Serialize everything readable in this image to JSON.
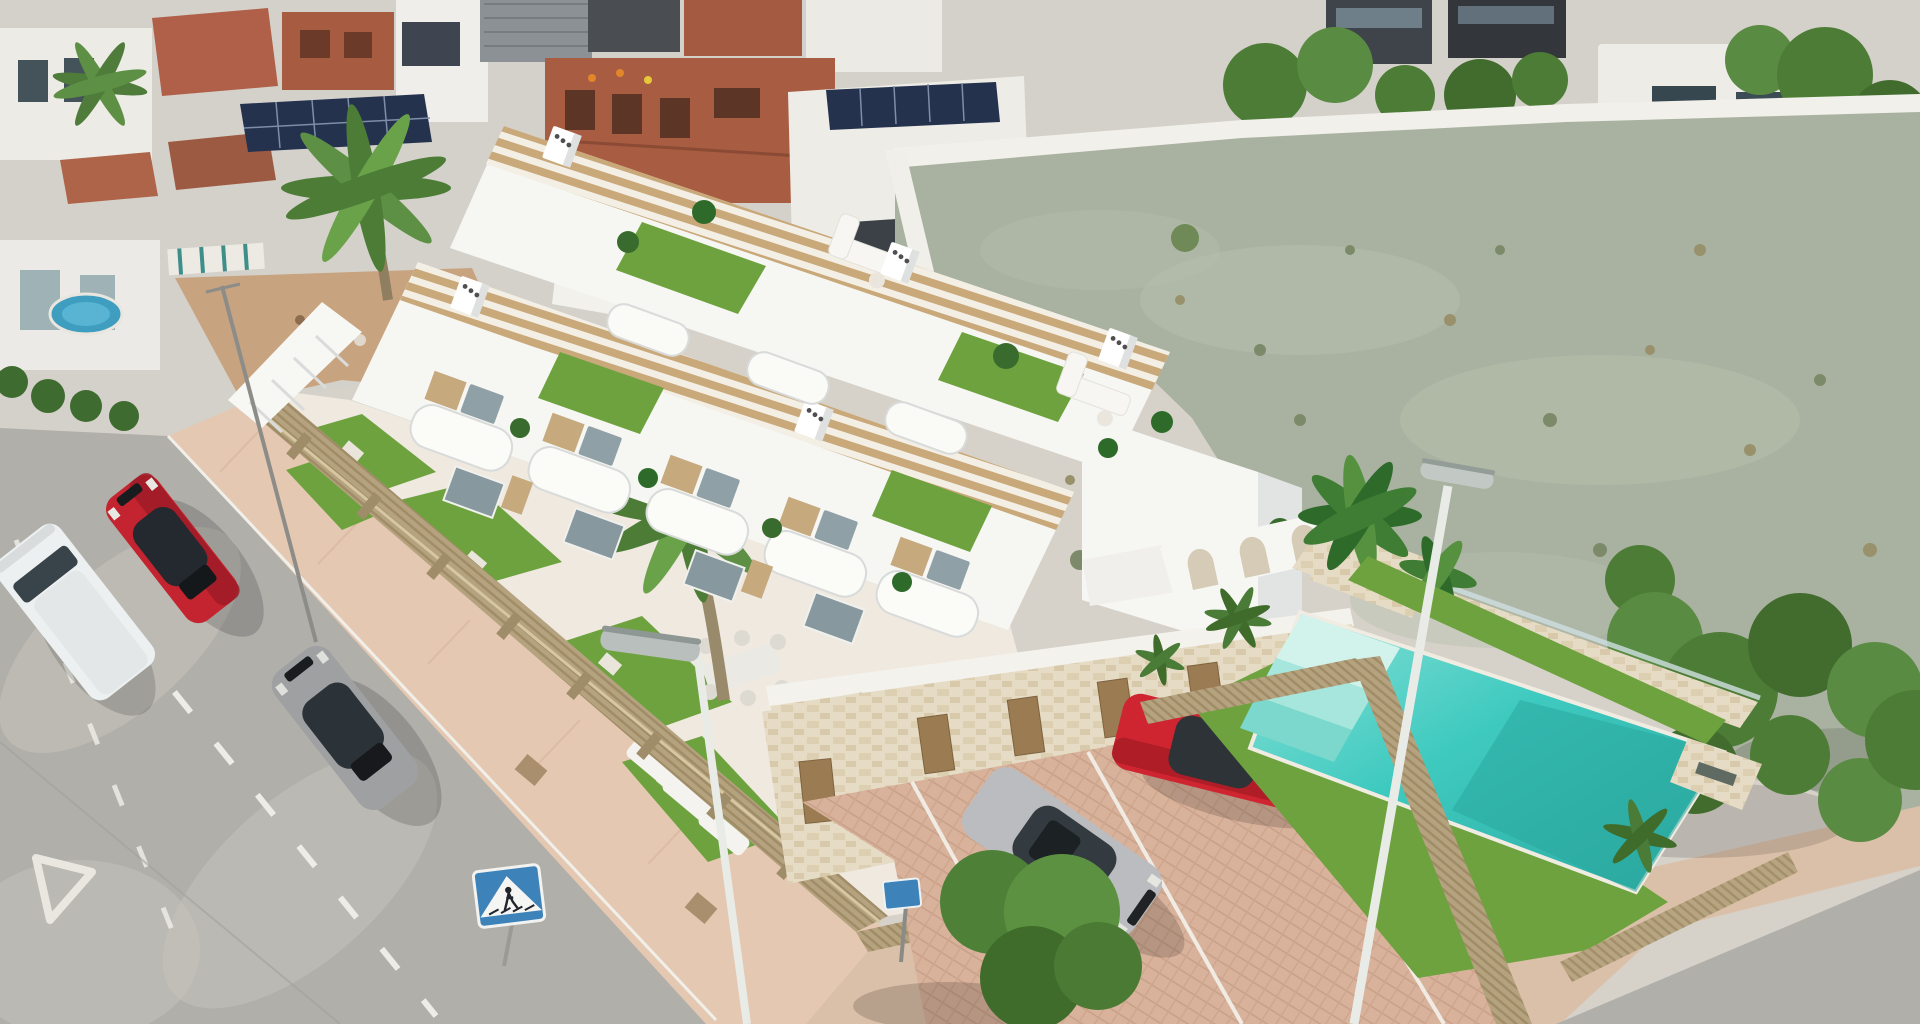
{
  "meta": {
    "title": "Aerial render of a new-build white townhouse complex with rooftop solariums, communal pool, parking court and adjacent vacant lot",
    "description": "Oblique drone view: modern white Mediterranean townhouses with wooden pergola solariums and artificial-grass terraces, tan slatted fences, travertine storage block, brick-paved parking with two cars, turquoise pool behind an arched white wall, surrounded by an existing village, streets with parked cars and a large sage-green vacant lot."
  },
  "palette": {
    "base": "#d6d2c9",
    "town_base": "#d4d1ca",
    "house_white": "#eeece7",
    "roof_terracotta": "#b06048",
    "roof_brick": "#a75c42",
    "roof_dark": "#4a4e53",
    "roof_metal": "#8b9194",
    "solar_panel": "#25324e",
    "field": "#a9b2a0",
    "field_patch": "#b7bfae",
    "weed_green": "#7d8a6a",
    "weed_dry": "#98916c",
    "wall_white": "#f1f0ea",
    "road": "#b1afaa",
    "road_worn": "#c6c3bc",
    "marking_white": "#eeece6",
    "sidewalk": "#e5c8b1",
    "sidewalk_dark": "#dbc0a9",
    "fence_tan": "#b5a27f",
    "fence_post": "#9f8c68",
    "building_white": "#f6f6f3",
    "building_shade": "#e2e4e4",
    "pergola_wood": "#c9a87a",
    "glass": "#8fa1a7",
    "wood_slat": "#c6a97d",
    "grass": "#6da23f",
    "stone": "#e6dcc5",
    "stone_cap": "#f4f2ec",
    "door_brown": "#9a7b52",
    "parking": "#d9b29c",
    "pool_water": "#3fcac0",
    "pool_deep": "#2aa89f",
    "pool_step": "#a6e6dc",
    "plant_dark": "#2e6b2b",
    "plant_mid": "#3f7d35",
    "palm_green": "#4f8f3f",
    "tree_green": "#4e8038",
    "tree_dark": "#3f6b2b",
    "car_red": "#c3242f",
    "car_red2": "#ce2531",
    "car_silver": "#bbbcbf",
    "car_gray": "#9fa0a2",
    "van_white": "#edf0f0",
    "window_dark": "#2f373e",
    "sign_blue": "#3d83ba",
    "lamp_pole": "#e9ebe7"
  },
  "scene": {
    "background_town": {
      "label": "Existing village rooftops",
      "features": [
        "white houses",
        "terracotta and brick roofs",
        "rooftop solar panels",
        "brick building under construction with workers",
        "large palm tree",
        "dark modern buildings",
        "white villa with perimeter wall",
        "wooden shed",
        "small above-ground pool",
        "striped awning"
      ]
    },
    "vacant_lot": {
      "label": "Large vacant sage-green lot with sparse scrub behind the development"
    },
    "development": {
      "label": "New-build white townhouse complex",
      "features": [
        "rooftop solariums with wooden pergolas",
        "chimney stacks with vent holes",
        "artificial-grass roof terraces with white lounge sofas and potted plants",
        "curved white balconies",
        "wood-slat shutters and glass sliders",
        "tan slatted privacy fence",
        "private patios with artificial grass, sun loungers and outdoor dining set",
        "patio palm tree",
        "external white staircase",
        "travertine storage block with timber doors"
      ]
    },
    "pool_area": {
      "label": "Communal pool garden",
      "features": [
        "white arched wall",
        "banana plants in stone planter",
        "turquoise pool with roman steps",
        "raised stone water feature",
        "artificial grass surround",
        "slatted fences",
        "glass-topped boundary wall"
      ]
    },
    "parking": {
      "label": "Brick-paved parking court with white bay markings"
    },
    "streets": {
      "label": "Concrete streets with dashed centre lines, yield triangle marking and pink paver sidewalks"
    },
    "vehicles": [
      {
        "name": "white-van",
        "desc": "White van parked at the left kerb",
        "color_key": "van_white"
      },
      {
        "name": "red-coupe",
        "desc": "Red sportback parked on the left street",
        "color_key": "car_red"
      },
      {
        "name": "grey-coupe",
        "desc": "Grey coupe parked on the left street",
        "color_key": "car_gray"
      },
      {
        "name": "silver-sedan",
        "desc": "Silver sedan in the parking court",
        "color_key": "car_silver"
      },
      {
        "name": "red-sedan",
        "desc": "Red sedan in the parking court",
        "color_key": "car_red2"
      }
    ],
    "street_furniture": [
      {
        "name": "street-lamp-left",
        "desc": "Thin utility pole on the upper left street"
      },
      {
        "name": "street-lamp-centre",
        "desc": "Street lamp beside the development"
      },
      {
        "name": "street-lamp-pool",
        "desc": "Street lamp leaning across the pool garden"
      },
      {
        "name": "pedestrian-crossing-sign",
        "desc": "Blue pedestrian-crossing sign on the sidewalk corner"
      },
      {
        "name": "parking-sign",
        "desc": "Small blue sign at the parking entrance"
      }
    ]
  }
}
